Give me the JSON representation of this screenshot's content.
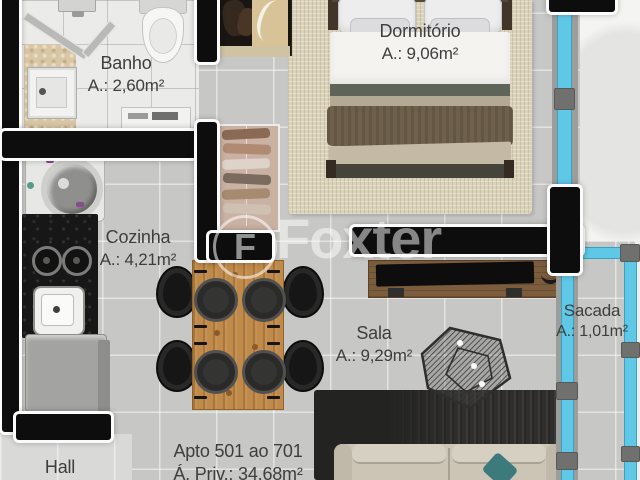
{
  "watermark": {
    "brand": "Foxter",
    "logo_char": "F"
  },
  "rooms": {
    "banho": {
      "name": "Banho",
      "area": "A.: 2,60m²"
    },
    "cozinha": {
      "name": "Cozinha",
      "area": "A.: 4,21m²"
    },
    "dormitorio": {
      "name": "Dormitório",
      "area": "A.: 9,06m²"
    },
    "sala": {
      "name": "Sala",
      "area": "A.: 9,29m²"
    },
    "sacada": {
      "name": "Sacada",
      "area": "A.: 1,01m²"
    },
    "hall": {
      "name": "Hall"
    }
  },
  "apartment": {
    "units": "Apto 501 ao 701",
    "private_area": "Á. Priv.: 34,68m²"
  },
  "furniture": {
    "banho": [
      "shower",
      "toilet",
      "vanity-sink",
      "bath-mat",
      "shelf"
    ],
    "cozinha": [
      "washing-machine",
      "cooktop-counter",
      "kitchen-sink",
      "fridge",
      "dining-table",
      "four-chairs"
    ],
    "dormitorio": [
      "double-bed",
      "wardrobe",
      "closet-shelves",
      "window"
    ],
    "sala": [
      "tv-console",
      "tv",
      "coffee-table",
      "dark-rug",
      "sofa",
      "teal-pillow"
    ],
    "sacada": [
      "glass-door",
      "glass-railing"
    ]
  },
  "colors": {
    "wall": "#0d0d0d",
    "wall_outline": "#fbfbfb",
    "floor_tile": "#c7c7c5",
    "bath_floor": "#ebebe9",
    "bedroom_rug": "#dbd2ba",
    "living_rug": "#2f2e2c",
    "glass": "#5fc8e7",
    "table_wood": "#c08a4a",
    "console_wood": "#7b5c3d",
    "sofa": "#ccc5b6",
    "accent_pillow": "#3c7a7c",
    "counter": "#171717",
    "label_text": "#3e3e3e",
    "watermark": "#ffffff"
  }
}
